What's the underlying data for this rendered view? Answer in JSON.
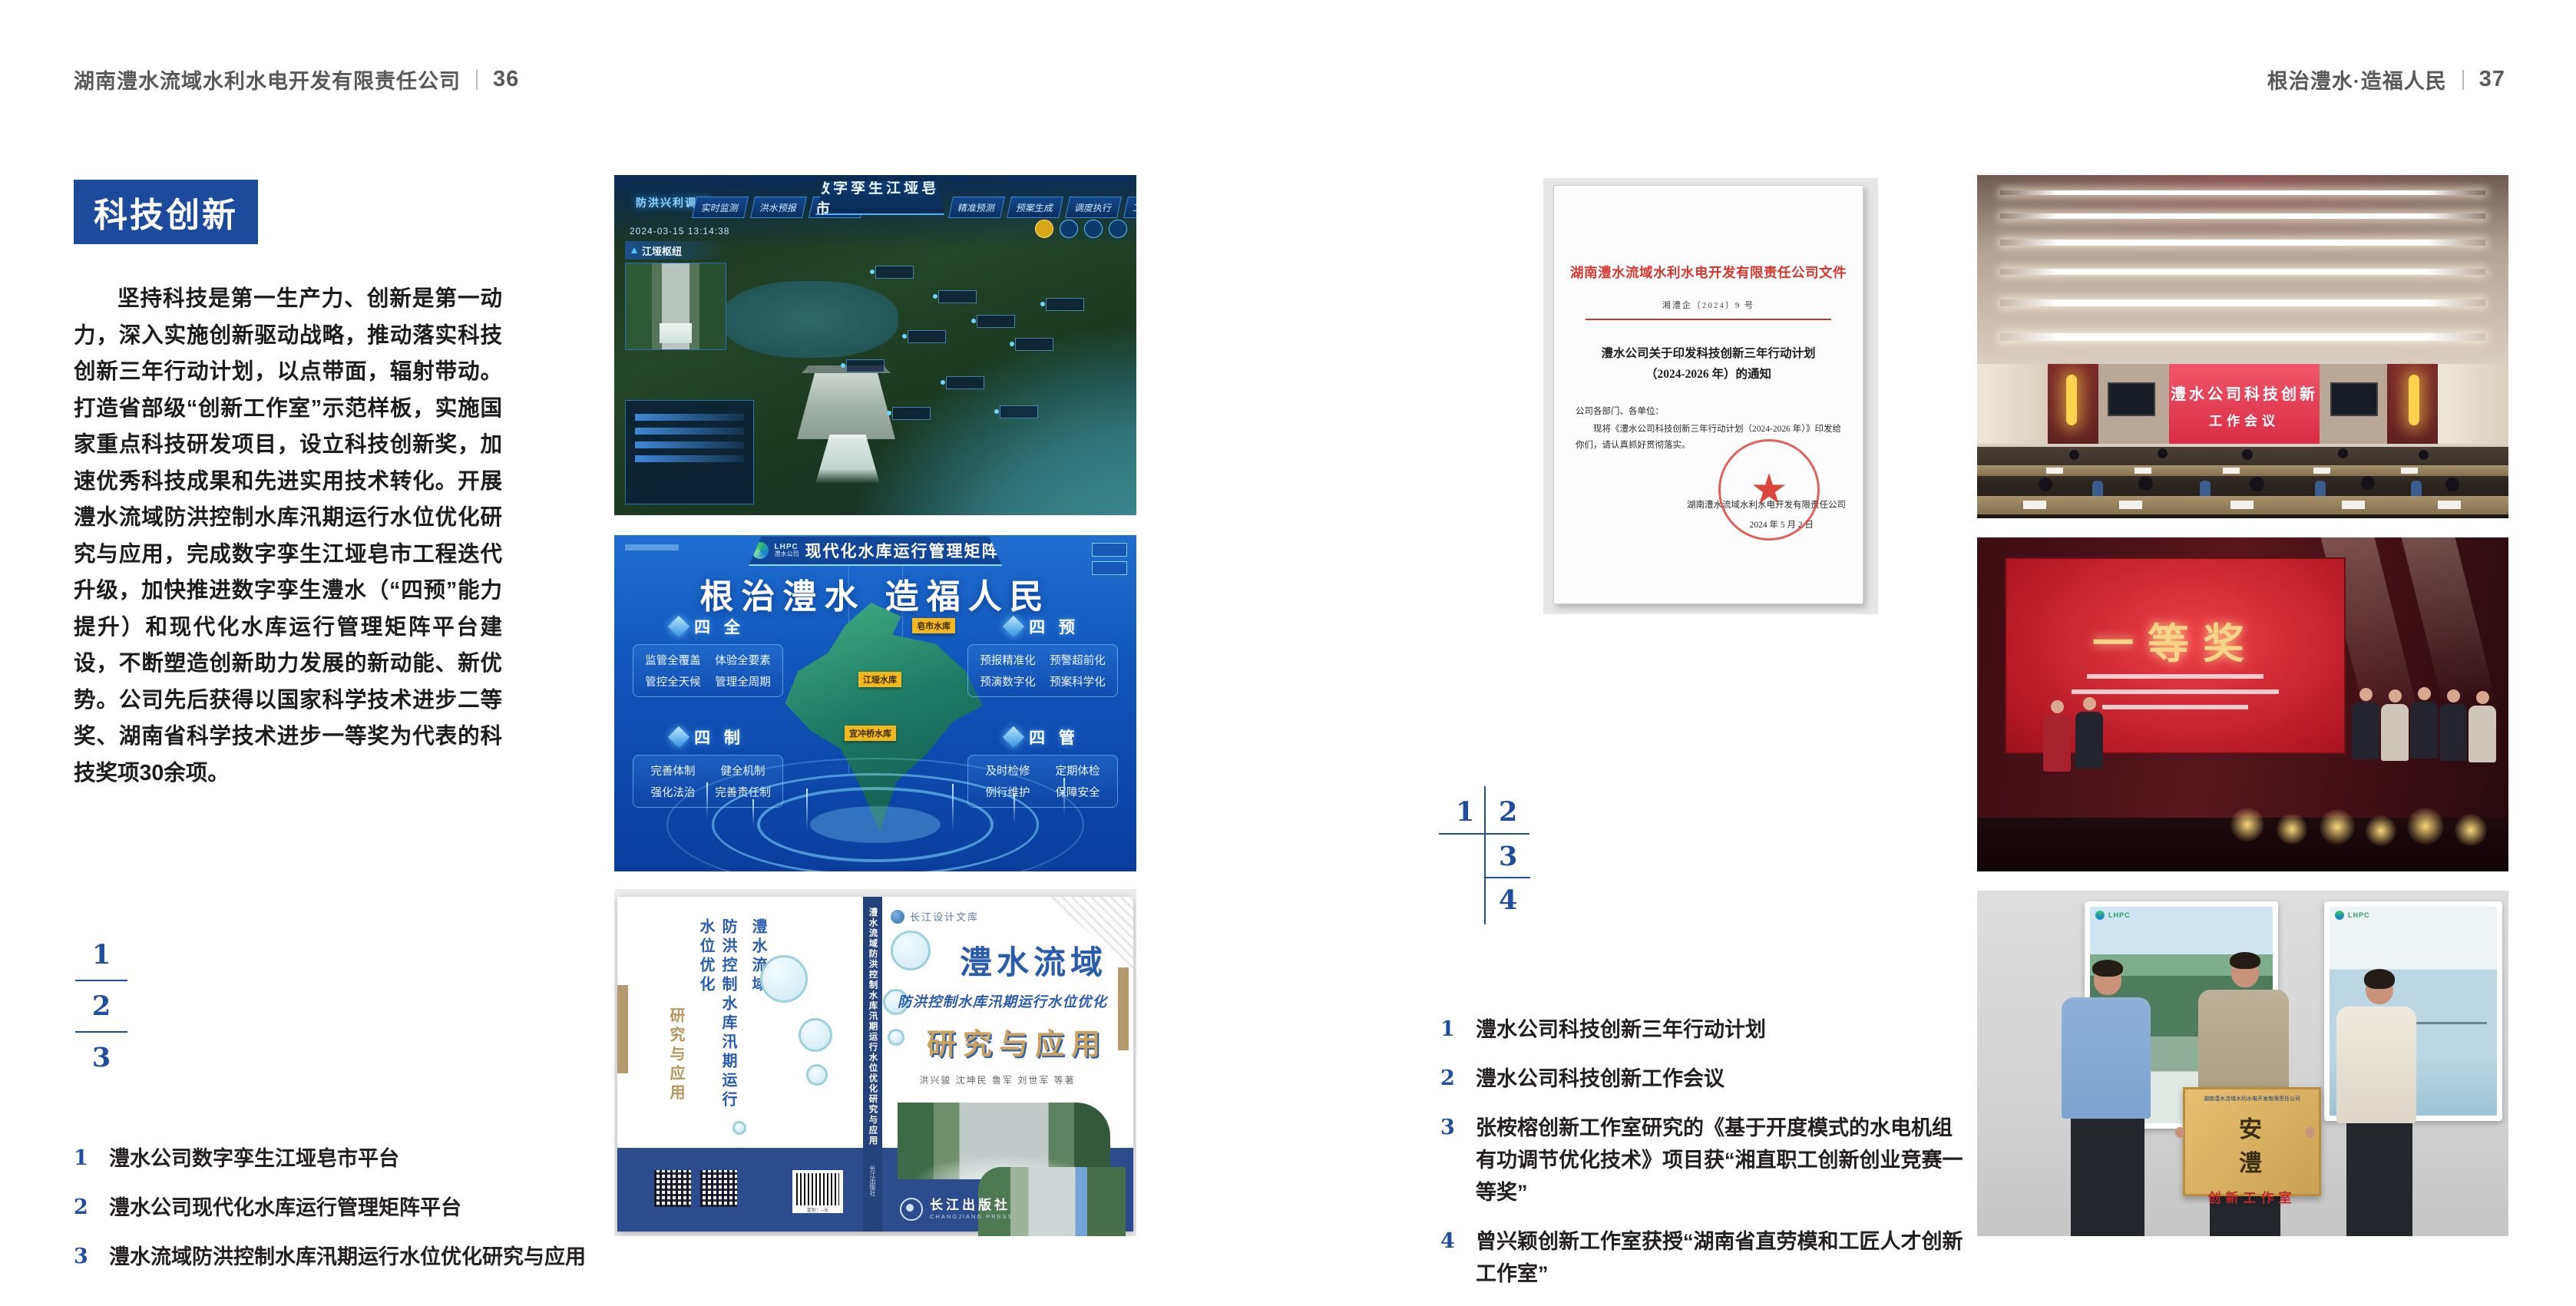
{
  "colors": {
    "accent_blue": "#1c4a9c",
    "key_blue": "#1f4e9e",
    "doc_red": "#d5372e"
  },
  "left_page": {
    "header": {
      "company": "湖南澧水流域水利水电开发有限责任公司",
      "page_no": "36"
    },
    "section_badge": "科技创新",
    "intro": "坚持科技是第一生产力、创新是第一动力，深入实施创新驱动战略，推动落实科技创新三年行动计划，以点带面，辐射带动。打造省部级“创新工作室”示范样板，实施国家重点科技研发项目，设立科技创新奖，加速优秀科技成果和先进实用技术转化。开展澧水流域防洪控制水库汛期运行水位优化研究与应用，完成数字孪生江垭皂市工程迭代升级，加快推进数字孪生澧水（“四预”能力提升）和现代化水库运行管理矩阵平台建设，不断塑造创新助力发展的新动能、新优势。公司先后获得以国家科学技术进步二等奖、湖南省科学技术进步一等奖为代表的科技奖项30余项。",
    "figure_keys": [
      "1",
      "2",
      "3"
    ],
    "captions": [
      {
        "num": "1",
        "text": "澧水公司数字孪生江垭皂市平台"
      },
      {
        "num": "2",
        "text": "澧水公司现代化水库运行管理矩阵平台"
      },
      {
        "num": "3",
        "text": "澧水流域防洪控制水库汛期运行水位优化研究与应用"
      }
    ],
    "fig_digital_twin": {
      "system_label": "防洪兴利调度",
      "title": "数字孪生江垭皂市",
      "tabs_left": [
        "实时监测",
        "洪水预报",
        "防洪预警"
      ],
      "tabs_right": [
        "精准预测",
        "预案生成",
        "调度执行",
        "工程探览"
      ],
      "timestamp": "2024-03-15 13:14:38",
      "panel_title": "江垭枢纽"
    },
    "fig_matrix": {
      "logo_abbr": "LHPC",
      "logo_name": "澧水公司",
      "title": "现代化水库运行管理矩阵",
      "slogan": "根治澧水 造福人民",
      "panels": [
        {
          "name": "四 全",
          "items": [
            "监管全覆盖",
            "体验全要素",
            "管控全天候",
            "管理全周期"
          ]
        },
        {
          "name": "四 预",
          "items": [
            "预报精准化",
            "预警超前化",
            "预演数字化",
            "预案科学化"
          ]
        },
        {
          "name": "四 制",
          "items": [
            "完善体制",
            "健全机制",
            "强化法治",
            "完善责任制"
          ]
        },
        {
          "name": "四 管",
          "items": [
            "及时检修",
            "定期体检",
            "例行维护",
            "保障安全"
          ]
        }
      ],
      "map_labels": [
        "皂市水库",
        "江垭水库",
        "宜冲桥水库"
      ]
    },
    "fig_book": {
      "series": "长江设计文库",
      "title_main": "澧水流域",
      "title_sub": "防洪控制水库汛期运行水位优化",
      "title_tail": "研究与应用",
      "authors": "洪兴骏 沈坤民 鲁军 刘世军 等著",
      "publisher": "长江出版社",
      "publisher_en": "CHANGJIANG PRESS",
      "spine_title": "澧水流域防洪控制水库汛期运行水位优化研究与应用",
      "barcode_label": "定价：--元"
    }
  },
  "right_page": {
    "header": {
      "motto": "根治澧水·造福人民",
      "page_no": "37"
    },
    "document": {
      "letterhead": "湖南澧水流域水利水电开发有限责任公司文件",
      "doc_no": "湘澧企〔2024〕9 号",
      "subject_line1": "澧水公司关于印发科技创新三年行动计划",
      "subject_line2": "（2024-2026 年）的通知",
      "salutation": "公司各部门、各单位：",
      "body": "现将《澧水公司科技创新三年行动计划（2024-2026 年）》印发给你们，请认真抓好贯彻落实。",
      "signer": "湖南澧水流域水利水电开发有限责任公司",
      "date": "2024 年 5 月 2 日"
    },
    "figure_keys": [
      "1",
      "2",
      "3",
      "4"
    ],
    "captions": [
      {
        "num": "1",
        "text": "澧水公司科技创新三年行动计划"
      },
      {
        "num": "2",
        "text": "澧水公司科技创新工作会议"
      },
      {
        "num": "3",
        "text": "张桉榕创新工作室研究的《基于开度模式的水电机组有功调节优化技术》项目获“湘直职工创新创业竞赛一等奖”"
      },
      {
        "num": "4",
        "text": "曾兴颖创新工作室获授“湖南省直劳模和工匠人才创新工作室”"
      }
    ],
    "photo_meeting": {
      "screen_line1": "澧水公司科技创新",
      "screen_line2": "工作会议"
    },
    "photo_award": {
      "screen_title": "一等奖"
    },
    "photo_studio": {
      "plaque_org": "湖南澧水流域水利水电开发有限责任公司",
      "plaque_name": "安 澧",
      "plaque_sub": "创新工作室",
      "poster_logo": "LHPC"
    }
  }
}
